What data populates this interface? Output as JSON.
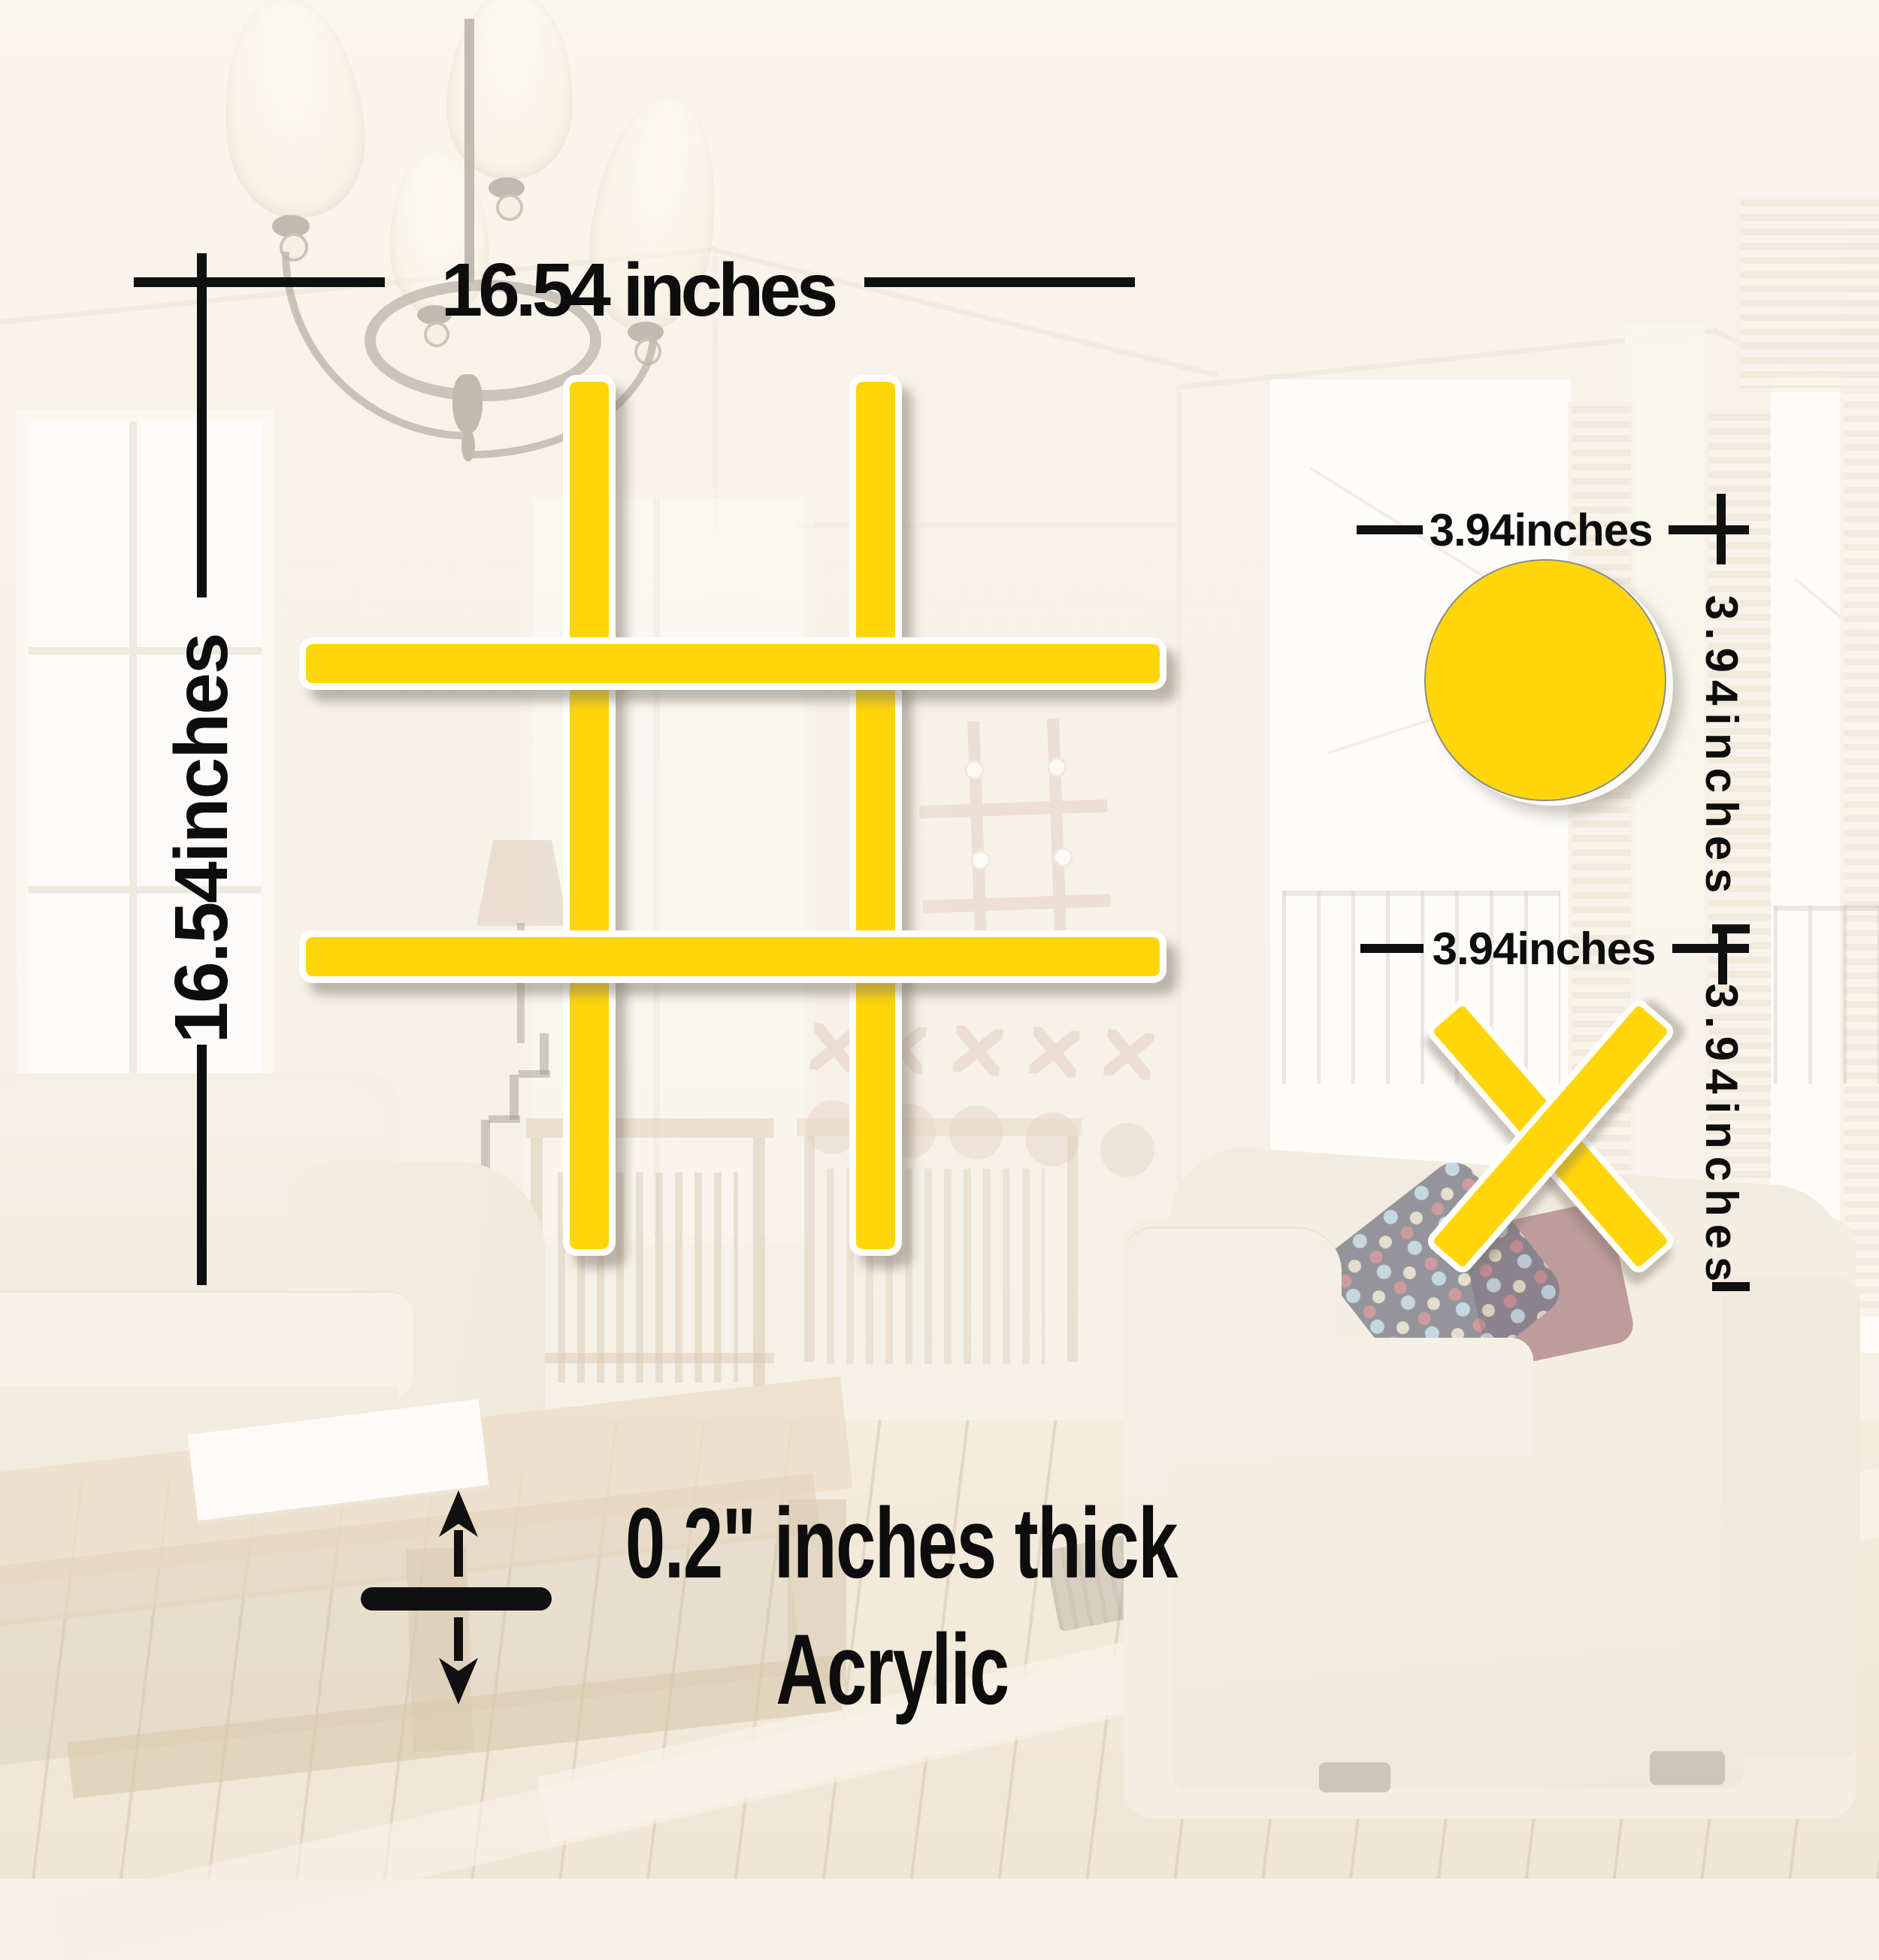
{
  "labels": {
    "grid_width": "16.54 inches",
    "grid_height": "16.54inches",
    "circle_width": "3.94inches",
    "circle_height": "3.94inches",
    "x_width": "3.94inches",
    "x_height": "3.94inches",
    "thickness_line1": "0.2\" inches thick",
    "thickness_line2": "Acrylic"
  },
  "shapes": {
    "grid": "tic-tac-toe-grid-piece",
    "circle": "o-game-piece",
    "x": "x-game-piece"
  },
  "colors": {
    "accent_yellow": "#FFD60A",
    "annotation_black": "#101010",
    "decal_pink": "#E3CFC3",
    "background_cream": "#F4EEE3"
  }
}
